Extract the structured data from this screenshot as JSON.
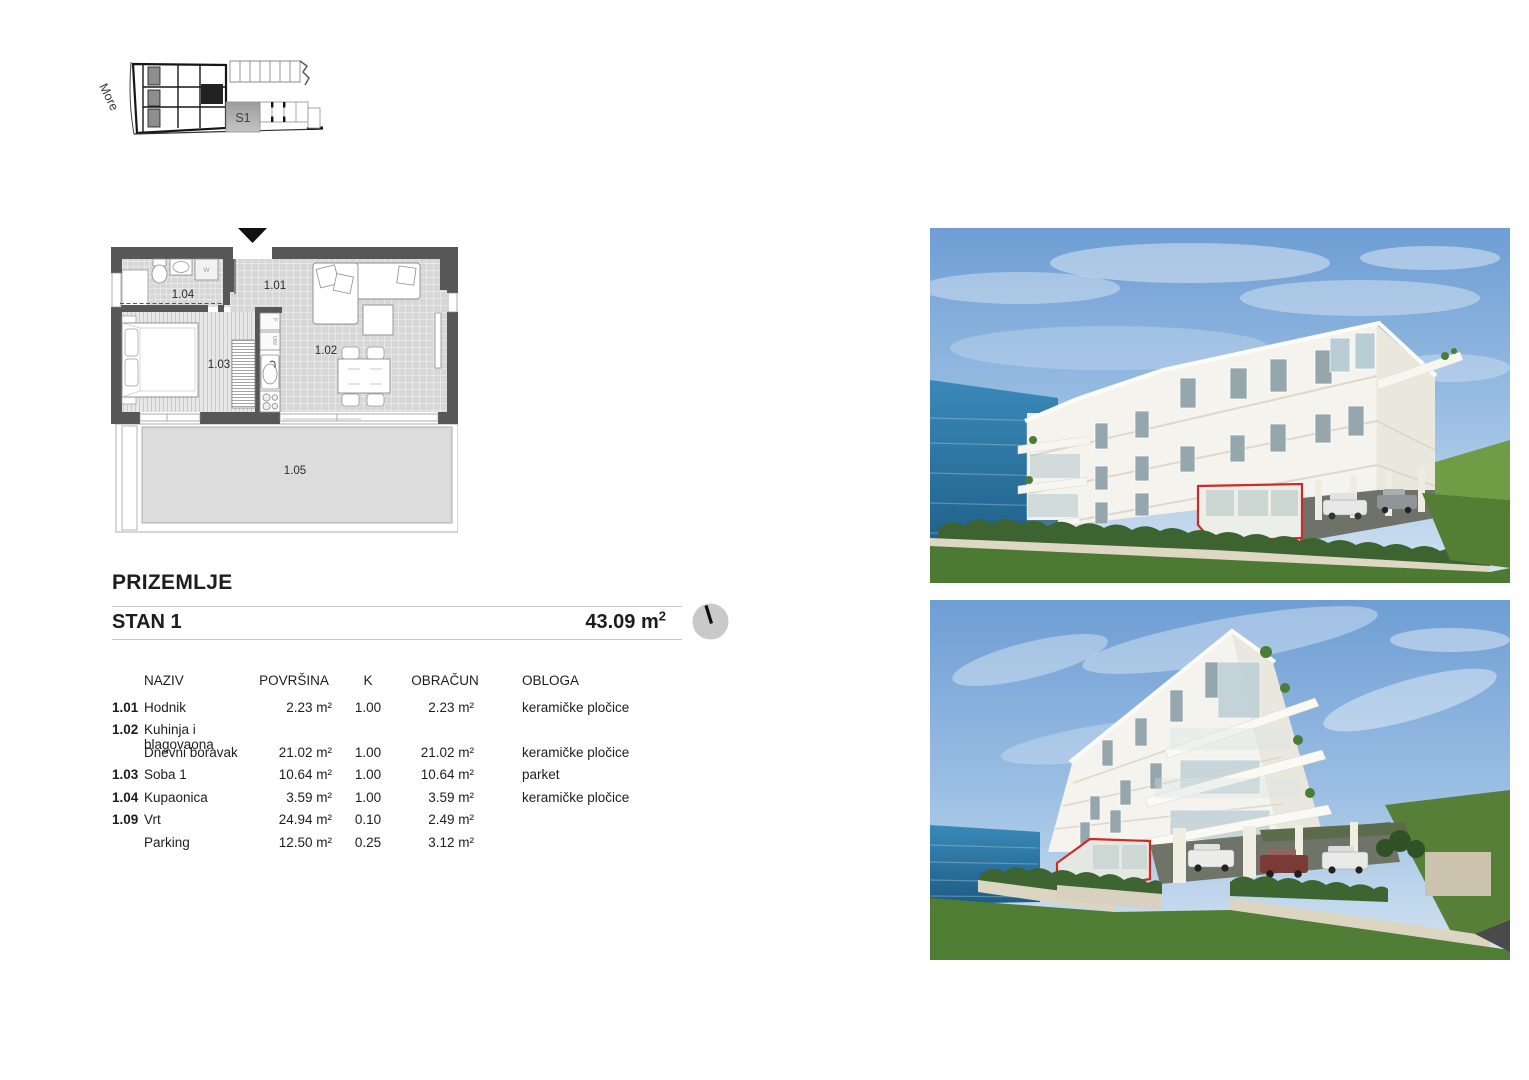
{
  "site_plan": {
    "sea_label": "More",
    "unit_label": "S1"
  },
  "floor_plan": {
    "room_101": "1.01",
    "room_102": "1.02",
    "room_103": "1.03",
    "room_104": "1.04",
    "room_105": "1.05",
    "washer_label": "W",
    "dishwasher_label": "DW",
    "fridge_label": "F"
  },
  "header": {
    "floor_title": "PRIZEMLJE",
    "unit_name": "STAN 1",
    "area_value": "43.09",
    "area_unit": "m",
    "area_exponent": "2"
  },
  "table": {
    "headers": {
      "naziv": "NAZIV",
      "povrsina": "POVRŠINA",
      "k": "K",
      "obracun": "OBRAČUN",
      "obloga": "OBLOGA"
    },
    "rows": [
      {
        "id": "1.01",
        "name": "Hodnik",
        "area": "2.23 m²",
        "k": "1.00",
        "calc": "2.23 m²",
        "finish": "keramičke pločice"
      },
      {
        "id": "1.02",
        "name": "Kuhinja i blagovaona",
        "area": "",
        "k": "",
        "calc": "",
        "finish": ""
      },
      {
        "id": "",
        "name": "Dnevni boravak",
        "area": "21.02 m²",
        "k": "1.00",
        "calc": "21.02 m²",
        "finish": "keramičke pločice"
      },
      {
        "id": "1.03",
        "name": "Soba 1",
        "area": "10.64 m²",
        "k": "1.00",
        "calc": "10.64 m²",
        "finish": "parket"
      },
      {
        "id": "1.04",
        "name": "Kupaonica",
        "area": "3.59 m²",
        "k": "1.00",
        "calc": "3.59 m²",
        "finish": "keramičke pločice"
      },
      {
        "id": "1.09",
        "name": "Vrt",
        "area": "24.94 m²",
        "k": "0.10",
        "calc": "2.49 m²",
        "finish": ""
      },
      {
        "id": "",
        "name": "Parking",
        "area": "12.50 m²",
        "k": "0.25",
        "calc": "3.12 m²",
        "finish": ""
      }
    ]
  },
  "colors": {
    "highlight_red": "#cf2b24",
    "wall_gray": "#575757",
    "terrace_gray": "#dcdcdc",
    "site_unit_gray": "#ababab"
  }
}
